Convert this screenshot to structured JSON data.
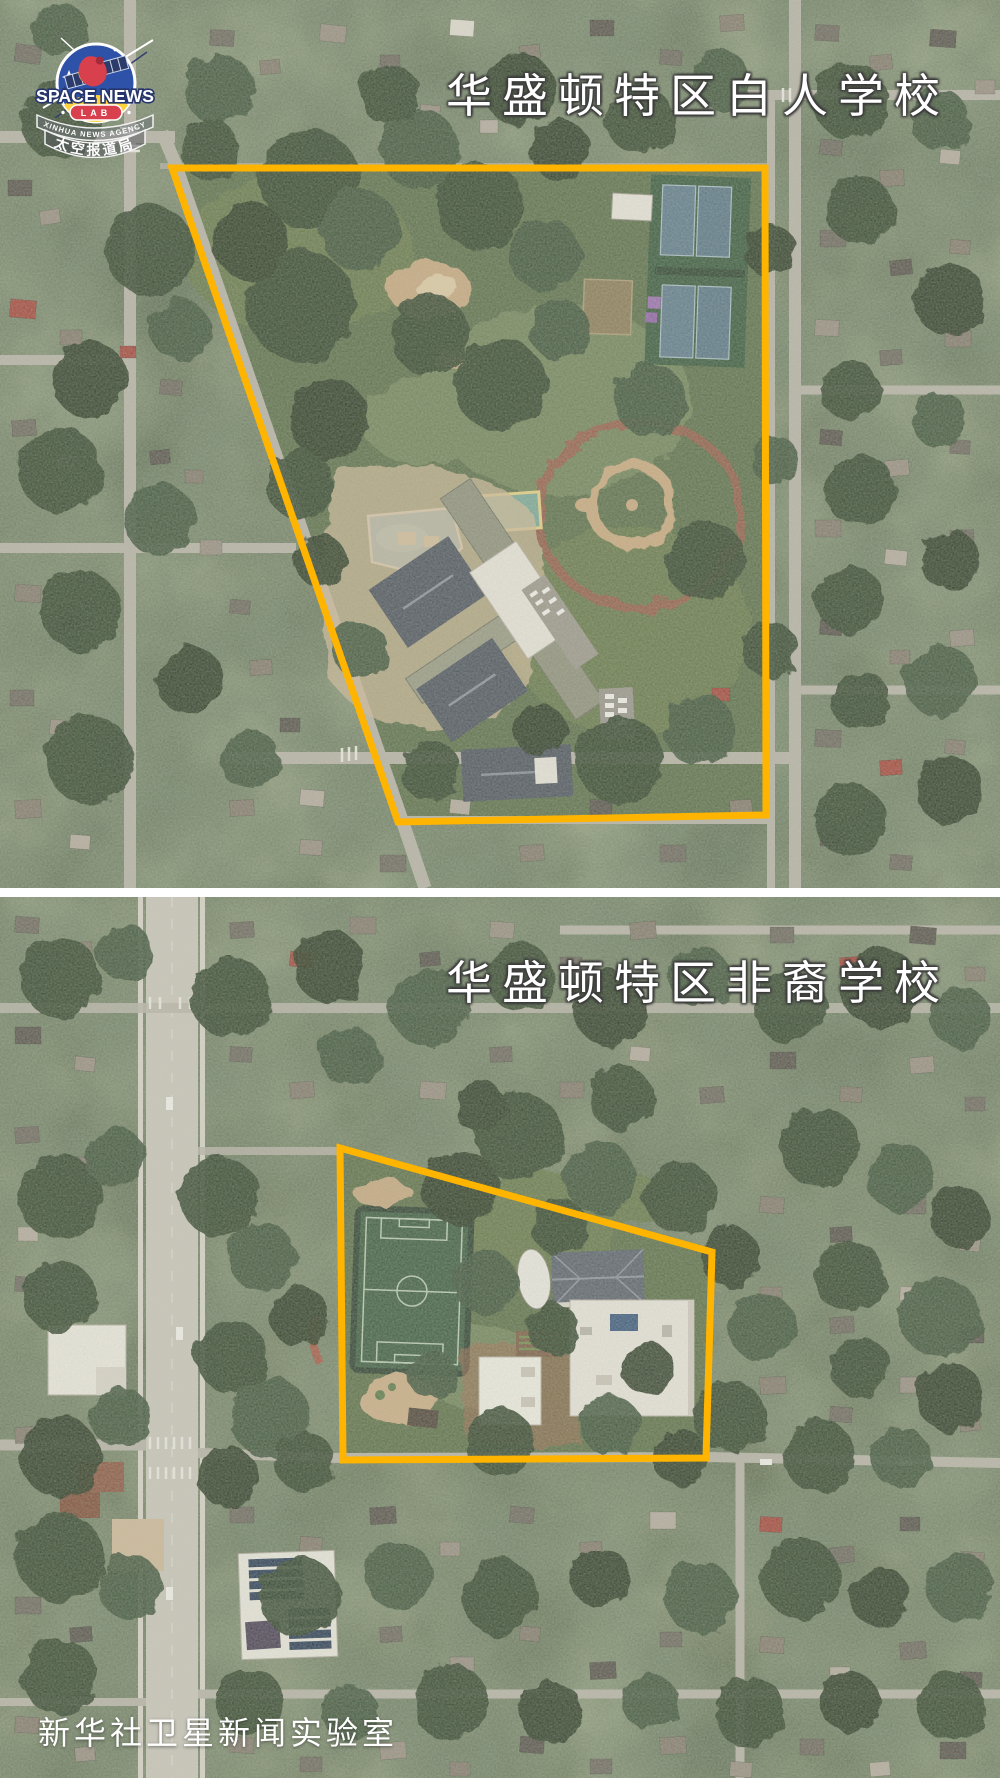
{
  "logo": {
    "title": "SPACE NEWS",
    "lab": "LAB",
    "agency": "XINHUA NEWS AGENCY",
    "bureau": "太空报道局"
  },
  "panels": [
    {
      "name": "washington-dc-white-school",
      "title": "华盛顿特区白人学校",
      "boundary_points": "172,168 765,168 766,815 398,822"
    },
    {
      "name": "washington-dc-black-school",
      "title": "华盛顿特区非裔学校",
      "boundary_points": "340,251 712,355 706,561 343,563"
    }
  ],
  "watermark": "新华社卫星新闻实验室",
  "colors": {
    "boundary": "#FFB400",
    "title_text": "#FFFFFF",
    "divider": "#FFFFFF",
    "logo_blue": "#2D52A8",
    "logo_red": "#D8404E",
    "logo_yellow": "#FFD23E"
  }
}
